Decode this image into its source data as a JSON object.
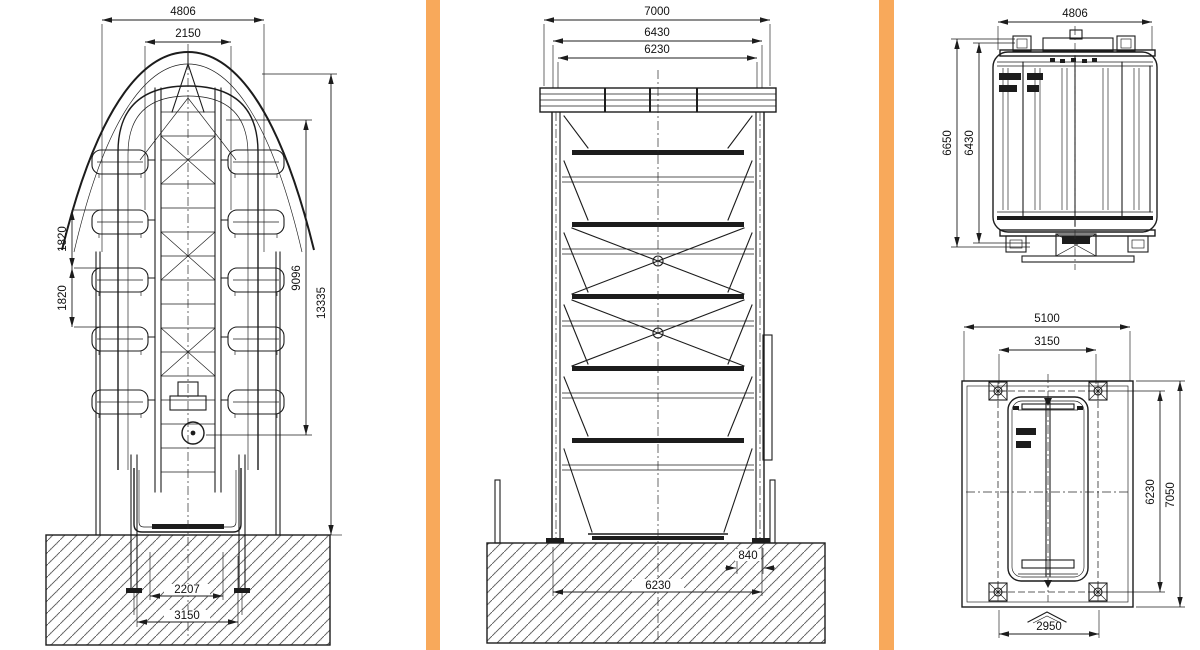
{
  "page": {
    "background": "#ffffff",
    "line_color": "#1c1c1c",
    "divider_color": "#F8A95B"
  },
  "drawing": {
    "type": "engineering-drawing",
    "subject": "vertical rotary parking system - dimensioned CAD views",
    "views": {
      "front_elevation": {
        "name": "front-elevation",
        "dims": {
          "overall_width": "4806",
          "inner_width": "2150",
          "level_pitch_upper": "1820",
          "level_pitch_lower": "1820",
          "drive_height": "9096",
          "overall_height": "13335",
          "anchor_span": "2207",
          "base_span": "3150"
        }
      },
      "side_elevation": {
        "name": "side-elevation",
        "dims": {
          "overall_width": "7000",
          "roof_width": "6430",
          "frame_width": "6230",
          "side_offset": "840",
          "foundation_span": "6230"
        }
      },
      "top_plan": {
        "name": "top-plan",
        "dims": {
          "overall_width": "4806",
          "overall_depth": "6650",
          "frame_depth": "6430"
        }
      },
      "foundation_plan": {
        "name": "foundation-plan",
        "dims": {
          "overall_width": "5100",
          "anchor_span_width": "3150",
          "anchor_span_depth": "6230",
          "overall_depth": "7050",
          "entry_width": "2950"
        }
      }
    }
  }
}
